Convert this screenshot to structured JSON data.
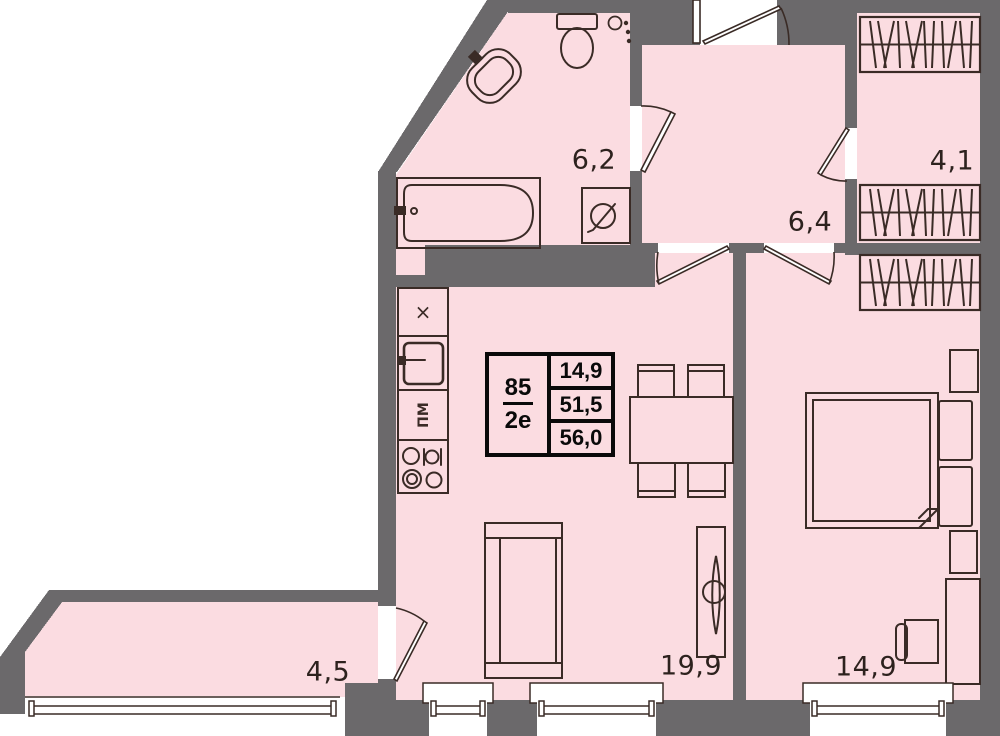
{
  "colors": {
    "wall": "#6b696b",
    "room_fill": "#fbdce1",
    "line": "#3a2b26",
    "label_text": "#2d221e",
    "card_text": "#0a0a0a"
  },
  "apartment_card": {
    "number": "85",
    "plan_type": "2е",
    "area_top": "14,9",
    "area_middle": "51,5",
    "area_bottom": "56,0"
  },
  "rooms": {
    "bathroom": {
      "label": "6,2"
    },
    "hallway": {
      "label": "6,4"
    },
    "wardrobe": {
      "label": "4,1"
    },
    "balcony": {
      "label": "4,5"
    },
    "kitchen_living": {
      "label": "19,9"
    },
    "bedroom": {
      "label": "14,9"
    }
  },
  "kitchen": {
    "hood_symbol": "×",
    "dishwasher_label": "ПМ"
  }
}
